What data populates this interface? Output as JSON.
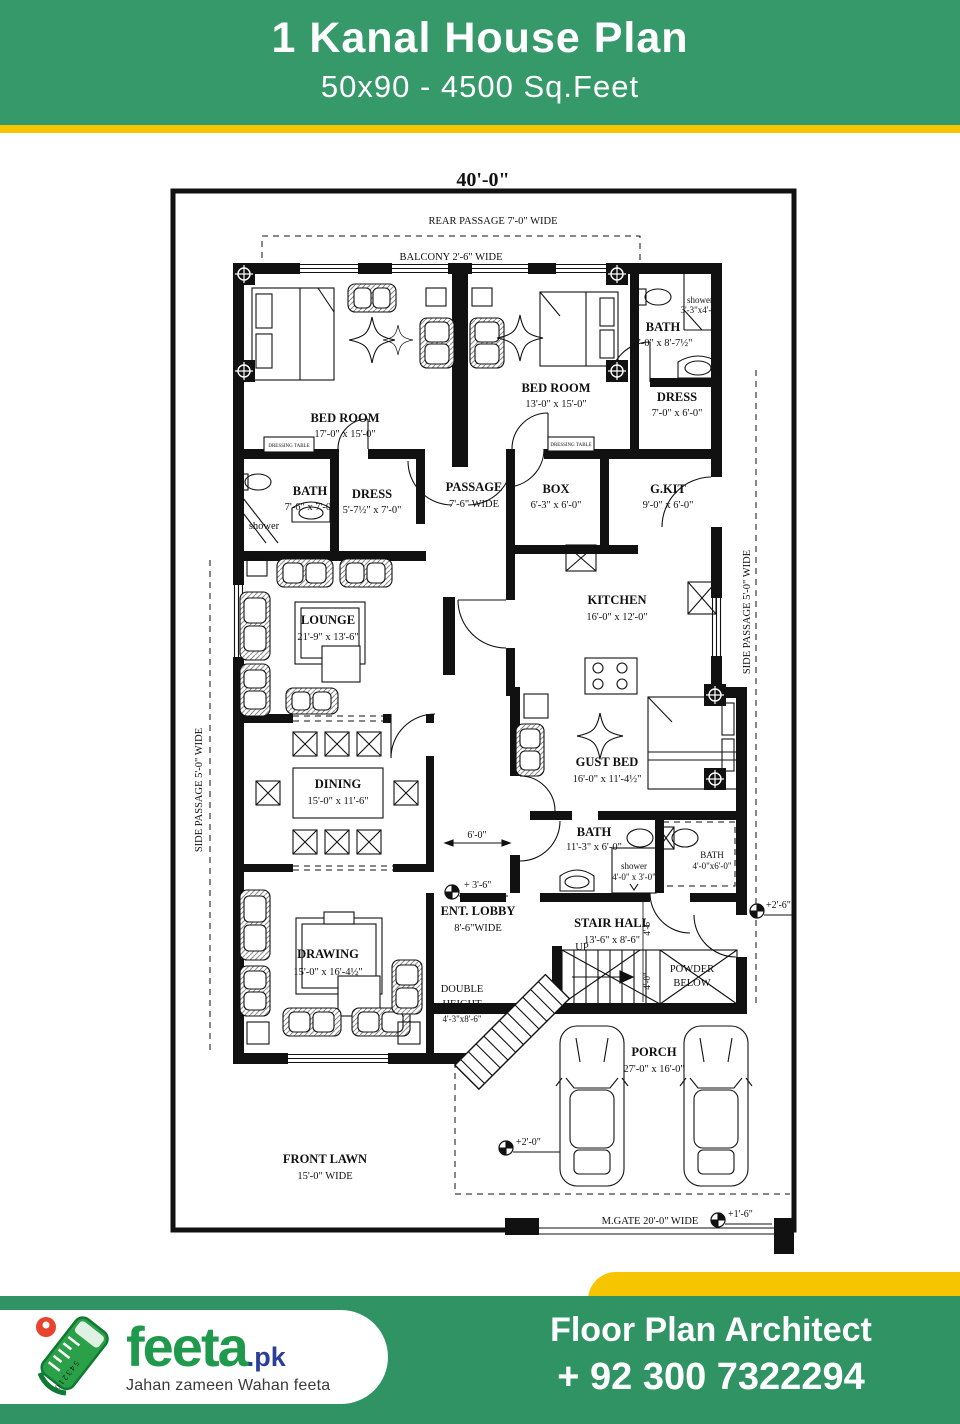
{
  "header": {
    "title": "1  Kanal House Plan",
    "subtitle": "50x90 - 4500 Sq.Feet"
  },
  "plan": {
    "labels": {
      "dim40": "40'-0\"",
      "rear_passage": "REAR PASSAGE 7'-0\" WIDE",
      "balcony": "BALCONY 2'-6\" WIDE",
      "bed1": {
        "n": "BED ROOM",
        "s": "17'-0\" x 15'-0\""
      },
      "bed2": {
        "n": "BED ROOM",
        "s": "13'-0\" x 15'-0\""
      },
      "bath_top": {
        "n": "BATH",
        "s": "7'-0\" x 8'-7½\""
      },
      "shower_top": {
        "n": "shower",
        "s": "3'-3\"x4'-0\""
      },
      "dress_top": {
        "n": "DRESS",
        "s": "7'-0\" x 6'-0\""
      },
      "bath_left": {
        "n": "BATH",
        "s": "7'-6\" x 7'-0\""
      },
      "shower_left": "shower",
      "dress_left": {
        "n": "DRESS",
        "s": "5'-7½\" x 7'-0\""
      },
      "passage": {
        "n": "PASSAGE",
        "s": "7'-6\" WIDE"
      },
      "box": {
        "n": "BOX",
        "s": "6'-3\" x 6'-0\""
      },
      "gkit": {
        "n": "G.KIT",
        "s": "9'-0\" x 6'-0\""
      },
      "kitchen": {
        "n": "KITCHEN",
        "s": "16'-0\" x 12'-0\""
      },
      "lounge": {
        "n": "LOUNGE",
        "s": "21'-9\" x 13'-6\""
      },
      "side_passage": "SIDE PASSAGE 5'-0\" WIDE",
      "dining": {
        "n": "DINING",
        "s": "15'-0\" x 11'-6\""
      },
      "gust_bed": {
        "n": "GUST BED",
        "s": "16'-0\" x 11'-4½\""
      },
      "bath_mid": {
        "n": "BATH",
        "s": "11'-3\" x 6'-0\""
      },
      "shower_mid": {
        "n": "shower",
        "s": "4'-0\" x 3'-0\""
      },
      "bath_right": {
        "n": "BATH",
        "s": "4'-0\"x6'-0\""
      },
      "ent_lobby": {
        "n": "ENT. LOBBY",
        "s": "8'-6\"WIDE"
      },
      "stair_hall": {
        "n": "STAIR HALL",
        "s": "13'-6\" x 8'-6\""
      },
      "up": "UP",
      "powder": {
        "l1": "POWDER",
        "l2": "BELOW"
      },
      "double_height": {
        "l1": "DOUBLE",
        "l2": "HEIGHT",
        "l3": "4'-3\"x8'-6\""
      },
      "drawing": {
        "n": "DRAWING",
        "s": "15'-0\" x 16'-4½\""
      },
      "porch": {
        "n": "PORCH",
        "s": "27'-0\" x 16'-0\""
      },
      "front_lawn": {
        "n": "FRONT LAWN",
        "s": "15'-0\" WIDE"
      },
      "m_gate": "M.GATE 20'-0\" WIDE",
      "dressing_table": "DRESSING TABLE",
      "dims": {
        "d36": "+ 3'-6\"",
        "d26": "+2'-6\"",
        "d20": "+2'-0\"",
        "d16": "+1'-6\"",
        "d60": "6'-0\"",
        "d46": "4'-6\"",
        "d40": "4'-0\""
      }
    }
  },
  "footer": {
    "heading": "Floor Plan Architect",
    "phone": "+ 92 300 7322294",
    "brand": "feeta",
    "brand_tld": ".pk",
    "tagline": "Jahan zameen Wahan feeta"
  },
  "colors": {
    "banner_green": "#36996a",
    "accent_yellow": "#f6c500",
    "footer_green": "#2f9363",
    "brand_green": "#1f9a4c",
    "brand_blue": "#2b3f98",
    "pin_red": "#e8432e",
    "plan_ink": "#111111"
  }
}
